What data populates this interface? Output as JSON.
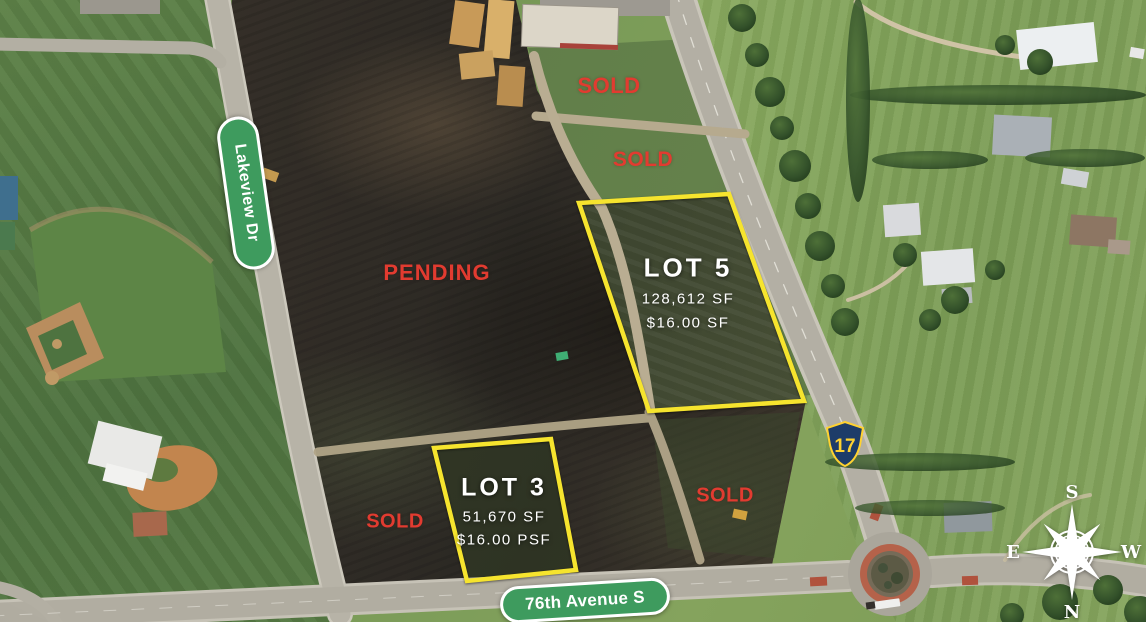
{
  "streets": {
    "lakeview": "Lakeview Dr",
    "avenue76": "76th Avenue S"
  },
  "shield": {
    "route": "17"
  },
  "labels": {
    "pending": "PENDING",
    "sold_top": "SOLD",
    "sold_mid": "SOLD",
    "sold_left": "SOLD",
    "sold_right": "SOLD"
  },
  "lots": {
    "lot5": {
      "name": "LOT 5",
      "area": "128,612 SF",
      "price": "$16.00 SF"
    },
    "lot3": {
      "name": "LOT 3",
      "area": "51,670 SF",
      "price": "$16.00 PSF"
    }
  },
  "compass": {
    "top": "S",
    "bottom": "N",
    "left": "E",
    "right": "W"
  },
  "colors": {
    "sold_red": "#E2382E",
    "boundary_yellow": "#F6E42E",
    "street_pill_green": "#3E9B5E",
    "shield_navy": "#1D3C69",
    "shield_yellow": "#FFD231",
    "label_white": "#FFFFFF"
  }
}
